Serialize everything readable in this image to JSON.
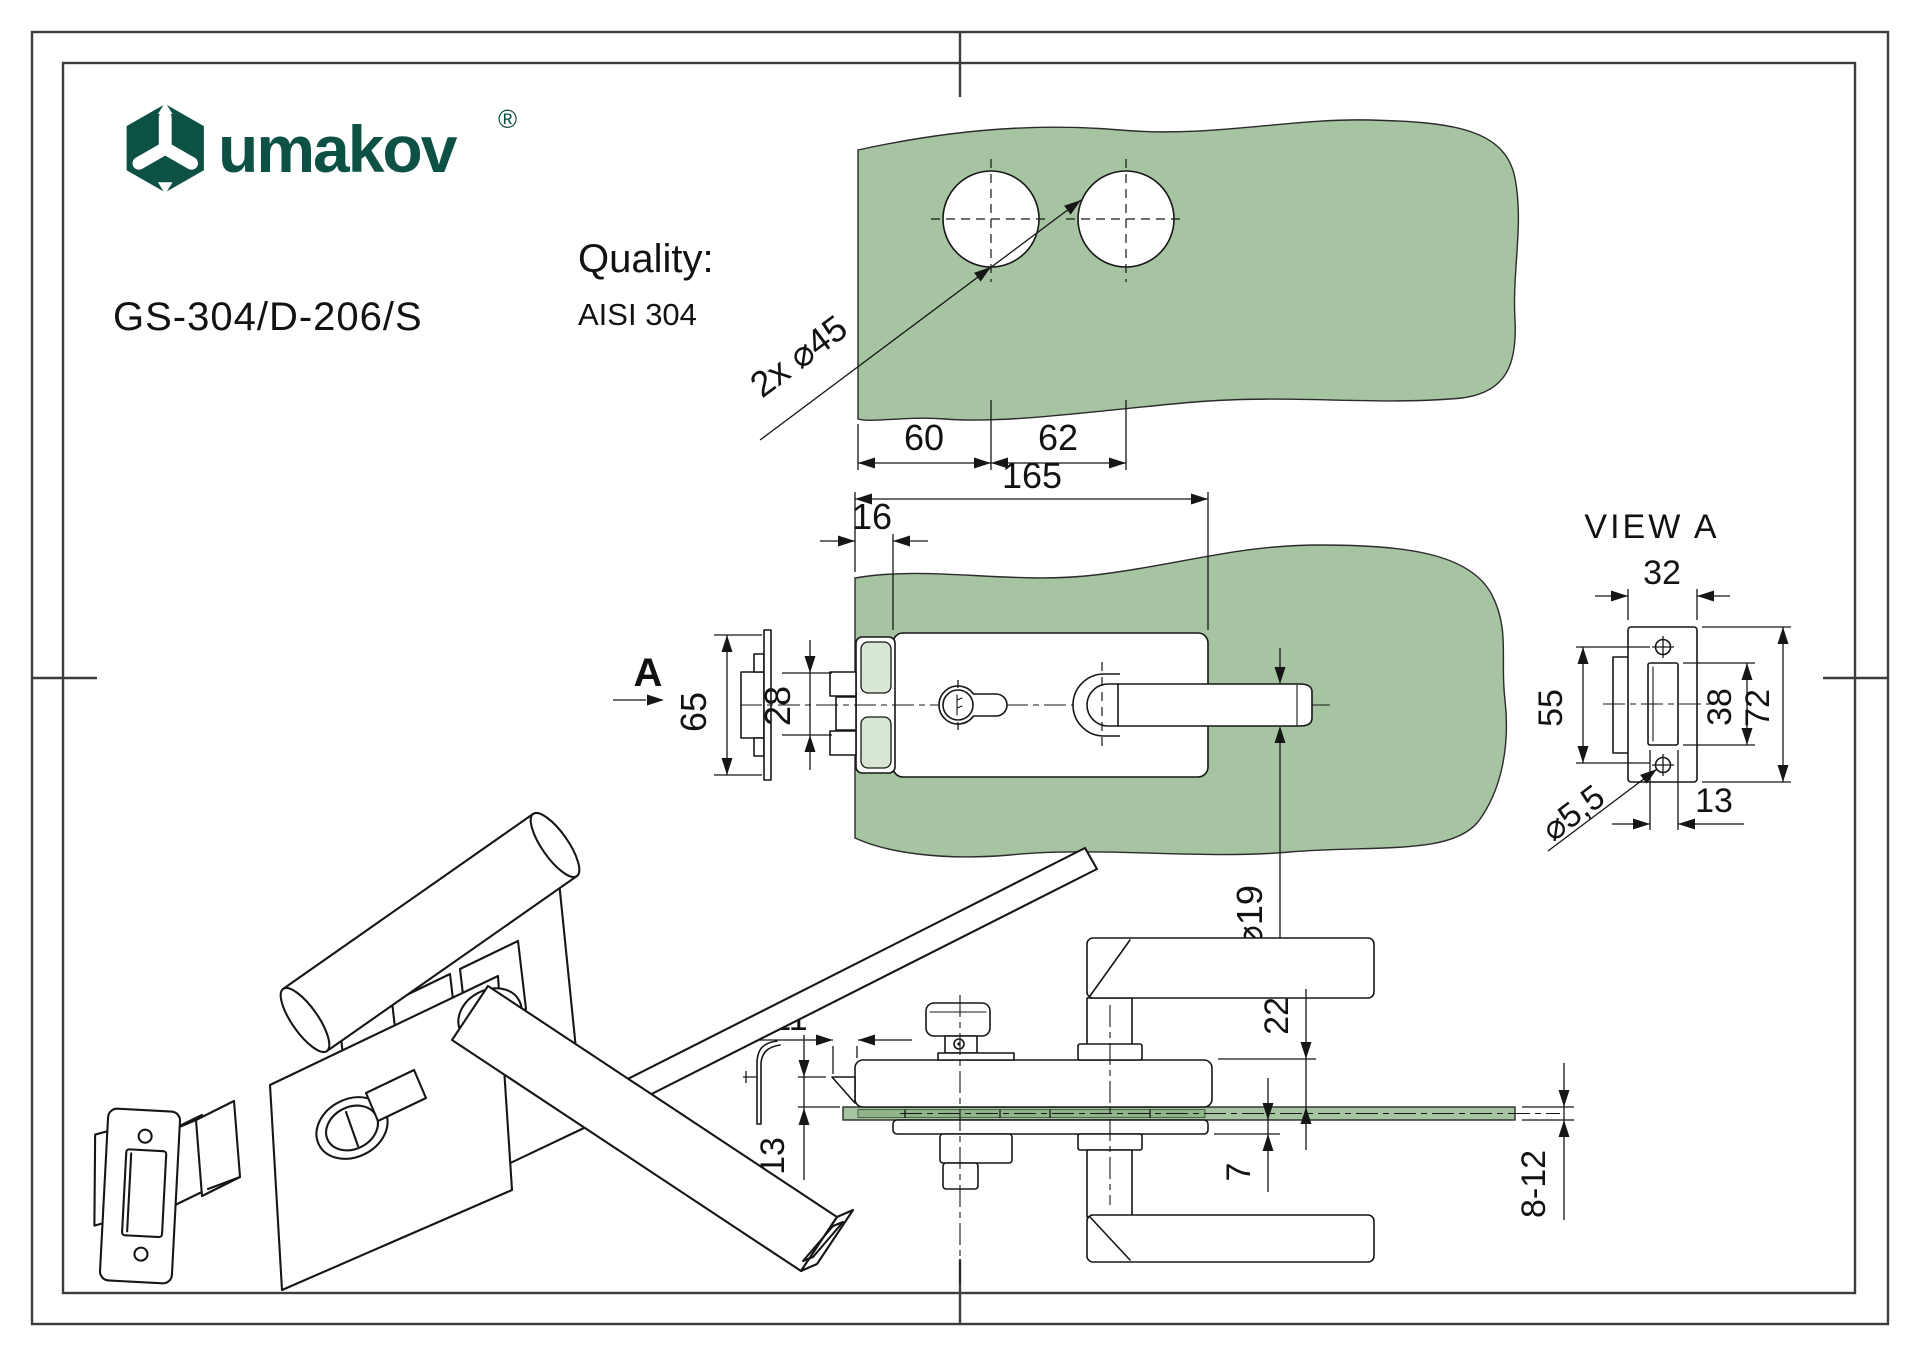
{
  "title_block": {
    "logo_text": "umakov",
    "logo_reg": "®",
    "product_code": "GS-304/D-206/S",
    "quality_label": "Quality:",
    "quality_value": "AISI 304"
  },
  "views": {
    "top_view": {
      "holes_label": "2x ⌀45",
      "hole_offset": "60",
      "hole_spacing": "62"
    },
    "front_view": {
      "direction_label": "A",
      "total_length": "165",
      "clamp_inset": "16",
      "strike_height": "65",
      "latch_height": "28",
      "shaft_diameter": "⌀19"
    },
    "view_a": {
      "title": "VIEW A",
      "plate_width": "32",
      "screw_spacing": "55",
      "slot_height": "38",
      "plate_height": "72",
      "slot_width": "13",
      "screw_hole_diameter": "⌀5,5"
    },
    "side_view": {
      "latch_offset": "11",
      "latch_drop": "13",
      "body_above_glass": "22",
      "plate_below_glass": "7",
      "glass_thickness": "8-12"
    }
  },
  "colors": {
    "brand": "#0d5044",
    "glass": "#a6c4a1",
    "glass_light": "#d8e7d4",
    "glass_dark": "#8fb48a",
    "ink": "#161616"
  }
}
